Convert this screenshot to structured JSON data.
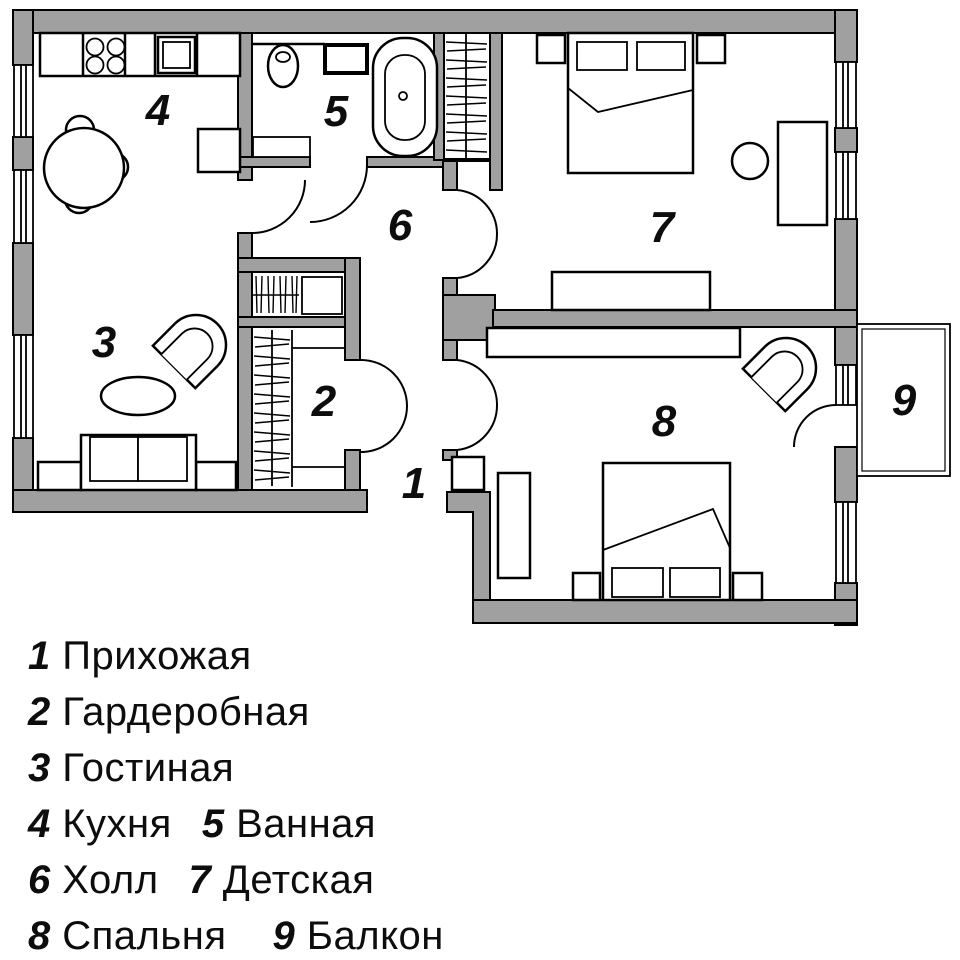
{
  "plan_title": "Apartment floor plan",
  "rooms": [
    {
      "num": "1",
      "label": "Прихожая"
    },
    {
      "num": "2",
      "label": "Гардеробная"
    },
    {
      "num": "3",
      "label": "Гостиная"
    },
    {
      "num": "4",
      "label": "Кухня"
    },
    {
      "num": "5",
      "label": "Ванная"
    },
    {
      "num": "6",
      "label": "Холл"
    },
    {
      "num": "7",
      "label": "Детская"
    },
    {
      "num": "8",
      "label": "Спальня"
    },
    {
      "num": "9",
      "label": "Балкон"
    }
  ],
  "colors": {
    "wall": "#a0a0a0",
    "line": "#000000",
    "background": "#ffffff",
    "text": "#0d0d0d"
  }
}
